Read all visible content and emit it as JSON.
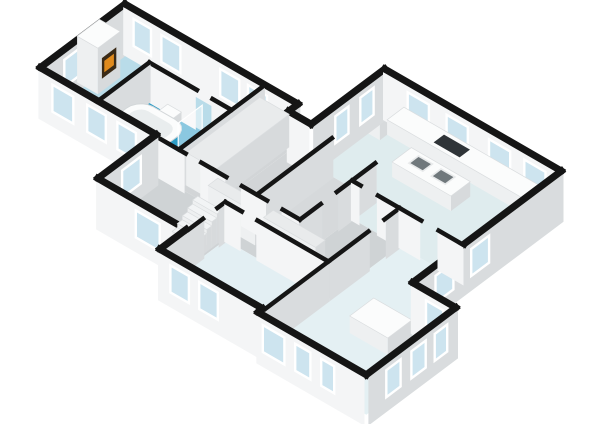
{
  "title": "3d-floor-plan",
  "colors": {
    "background": "#ffffff",
    "wall_cap": "#151515",
    "wall_face_bright": "#f4f5f6",
    "wall_face_shaded": "#d9dcde",
    "plinth": "#eceeef",
    "glass": "#cde4ef",
    "window_frame": "#ffffff",
    "floor_living": "#b9dce9",
    "floor_bathroom": "#2d9cc6",
    "floor_shower": "#1f87b6",
    "floor_hall": "#cfd3d5",
    "floor_storage": "#d2d5d7",
    "floor_kitchen": "#dfecee",
    "floor_bedroom": "#e3eff3",
    "fixture_white": "#f7f8f9",
    "fixture_top": "#fbfcfc",
    "fire_glow": "#e08a1c",
    "fire_dark": "#3a2a16",
    "sink_metal": "#70787c",
    "cooktop": "#2f3438"
  },
  "scene": {
    "origin": [
      125,
      44
    ],
    "u": [
      0.866,
      0.5
    ],
    "w": [
      -0.8,
      0.6
    ],
    "wall_height_ext": 40,
    "wall_height_int": 38,
    "plinth_extra": 8,
    "floors": [
      {
        "name": "living-room-floor",
        "color": "#b9dce9",
        "pts": [
          [
            0,
            0
          ],
          [
            160,
            0
          ],
          [
            160,
            40
          ],
          [
            65,
            40
          ],
          [
            65,
            106
          ],
          [
            0,
            106
          ]
        ]
      },
      {
        "name": "bathroom-floor",
        "color": "#2d9cc6",
        "pts": [
          [
            65,
            40
          ],
          [
            160,
            40
          ],
          [
            160,
            106
          ],
          [
            65,
            106
          ]
        ]
      },
      {
        "name": "wing-closet-zone-floor",
        "color": "#d2d5d7",
        "pts": [
          [
            160,
            0
          ],
          [
            200,
            0
          ],
          [
            200,
            106
          ],
          [
            160,
            106
          ]
        ]
      },
      {
        "name": "hallway-floor",
        "color": "#cfd3d5",
        "pts": [
          [
            134,
            106
          ],
          [
            300,
            106
          ],
          [
            300,
            41
          ],
          [
            355,
            41
          ],
          [
            355,
            130
          ],
          [
            236,
            130
          ],
          [
            236,
            179
          ],
          [
            134,
            179
          ]
        ]
      },
      {
        "name": "storage-room-1-floor",
        "color": "#d2d5d7",
        "pts": [
          [
            200,
            12
          ],
          [
            250,
            12
          ],
          [
            250,
            106
          ],
          [
            200,
            106
          ]
        ]
      },
      {
        "name": "storage-room-2-floor",
        "color": "#d6d9db",
        "pts": [
          [
            250,
            12
          ],
          [
            300,
            12
          ],
          [
            300,
            106
          ],
          [
            250,
            106
          ]
        ]
      },
      {
        "name": "kitchen-floor",
        "color": "#dfecee",
        "pts": [
          [
            226,
            -80
          ],
          [
            430,
            -80
          ],
          [
            430,
            41
          ],
          [
            300,
            41
          ],
          [
            300,
            12
          ],
          [
            226,
            12
          ]
        ]
      },
      {
        "name": "bedroom-1-floor",
        "color": "#e3eff3",
        "pts": [
          [
            236,
            130
          ],
          [
            355,
            130
          ],
          [
            355,
            212
          ],
          [
            236,
            212
          ]
        ]
      },
      {
        "name": "bedroom-2-floor",
        "color": "#e4f0f3",
        "pts": [
          [
            355,
            41
          ],
          [
            430,
            41
          ],
          [
            430,
            106
          ],
          [
            480,
            106
          ],
          [
            480,
            218
          ],
          [
            355,
            218
          ]
        ]
      }
    ],
    "walls": [
      {
        "name": "wing-north-wall",
        "p": [
          0,
          0,
          200,
          0
        ],
        "ext": true,
        "win": [
          [
            0.06,
            0.16
          ],
          [
            0.22,
            0.33
          ],
          [
            0.56,
            0.67
          ],
          [
            0.72,
            0.83
          ]
        ]
      },
      {
        "name": "wing-west-wall",
        "p": [
          0,
          0,
          0,
          106
        ],
        "ext": true,
        "win": [
          [
            0.5,
            0.74
          ]
        ]
      },
      {
        "name": "wing-south-wall",
        "p": [
          0,
          106,
          134,
          106
        ],
        "ext": true,
        "win": [
          [
            0.12,
            0.3
          ],
          [
            0.42,
            0.58
          ],
          [
            0.68,
            0.84
          ]
        ]
      },
      {
        "name": "hall-west-wall",
        "p": [
          134,
          106,
          134,
          179
        ],
        "ext": true,
        "win": [
          [
            0.3,
            0.62
          ]
        ]
      },
      {
        "name": "hall-south-wall",
        "p": [
          134,
          179,
          236,
          179
        ],
        "ext": true,
        "win": [
          [
            0.45,
            0.72
          ]
        ]
      },
      {
        "name": "bedroom-1-west-ext-wall",
        "p": [
          236,
          179,
          236,
          212
        ],
        "ext": true,
        "win": []
      },
      {
        "name": "bedroom-1-south-wall",
        "p": [
          236,
          212,
          355,
          212
        ],
        "ext": true,
        "win": [
          [
            0.12,
            0.3
          ],
          [
            0.4,
            0.58
          ]
        ]
      },
      {
        "name": "south-step-wall",
        "p": [
          355,
          212,
          355,
          218
        ],
        "ext": true,
        "win": []
      },
      {
        "name": "bedroom-2-south-wall",
        "p": [
          355,
          218,
          480,
          218
        ],
        "ext": true,
        "win": [
          [
            0.06,
            0.26
          ],
          [
            0.36,
            0.5
          ],
          [
            0.6,
            0.72
          ]
        ]
      },
      {
        "name": "bedroom-2-east-wall",
        "p": [
          480,
          218,
          480,
          106
        ],
        "ext": true,
        "win": [
          [
            0.2,
            0.36
          ],
          [
            0.48,
            0.64
          ],
          [
            0.74,
            0.88
          ]
        ]
      },
      {
        "name": "bedroom-2-north-ext-wall",
        "p": [
          480,
          106,
          430,
          106
        ],
        "ext": true,
        "win": [
          [
            0.25,
            0.65
          ]
        ]
      },
      {
        "name": "kitchen-east-wall",
        "p": [
          430,
          106,
          430,
          -80
        ],
        "ext": true,
        "win": [
          [
            0.14,
            0.26
          ],
          [
            0.38,
            0.5
          ]
        ]
      },
      {
        "name": "kitchen-north-wall",
        "p": [
          430,
          -80,
          226,
          -80
        ],
        "ext": true,
        "win": [
          [
            0.08,
            0.2
          ],
          [
            0.28,
            0.4
          ],
          [
            0.52,
            0.64
          ],
          [
            0.74,
            0.86
          ]
        ]
      },
      {
        "name": "kitchen-west-wall",
        "p": [
          226,
          -80,
          226,
          12
        ],
        "ext": true,
        "win": [
          [
            0.18,
            0.36
          ],
          [
            0.52,
            0.7
          ]
        ]
      },
      {
        "name": "storage-north-wall",
        "p": [
          226,
          12,
          200,
          12
        ],
        "ext": true,
        "win": []
      },
      {
        "name": "wing-east-jog-wall",
        "p": [
          200,
          12,
          200,
          0
        ],
        "ext": true,
        "win": []
      },
      {
        "name": "wing-south-int-a",
        "p": [
          134,
          106,
          168,
          106
        ],
        "ext": false,
        "win": []
      },
      {
        "name": "wing-south-int-b",
        "p": [
          186,
          106,
          200,
          106
        ],
        "ext": false,
        "win": []
      },
      {
        "name": "wing-divider-wall",
        "p": [
          160,
          0,
          160,
          106
        ],
        "ext": false,
        "win": []
      },
      {
        "name": "bathroom-west-wall",
        "p": [
          65,
          40,
          65,
          106
        ],
        "ext": false,
        "win": []
      },
      {
        "name": "bathroom-north-wall-a",
        "p": [
          65,
          40,
          120,
          40
        ],
        "ext": false,
        "win": []
      },
      {
        "name": "bathroom-north-wall-b",
        "p": [
          138,
          40,
          160,
          40
        ],
        "ext": false,
        "win": []
      },
      {
        "name": "storage-south-wall-a",
        "p": [
          200,
          106,
          215,
          106
        ],
        "ext": false,
        "win": []
      },
      {
        "name": "storage-south-wall-b",
        "p": [
          233,
          106,
          262,
          106
        ],
        "ext": false,
        "win": []
      },
      {
        "name": "storage-south-wall-c",
        "p": [
          280,
          106,
          300,
          106
        ],
        "ext": false,
        "win": []
      },
      {
        "name": "storage-divider-wall",
        "p": [
          250,
          12,
          250,
          106
        ],
        "ext": false,
        "win": []
      },
      {
        "name": "storage-east-wall-a",
        "p": [
          300,
          12,
          300,
          60
        ],
        "ext": false,
        "win": []
      },
      {
        "name": "storage-east-wall-b",
        "p": [
          300,
          80,
          300,
          106
        ],
        "ext": false,
        "win": []
      },
      {
        "name": "bedroom-1-north-wall-a",
        "p": [
          236,
          130,
          255,
          130
        ],
        "ext": false,
        "win": []
      },
      {
        "name": "bedroom-1-north-wall-b",
        "p": [
          273,
          130,
          355,
          130
        ],
        "ext": false,
        "win": []
      },
      {
        "name": "bedroom-1-west-wall-a",
        "p": [
          236,
          130,
          236,
          140
        ],
        "ext": false,
        "win": []
      },
      {
        "name": "bedroom-1-west-wall-b",
        "p": [
          236,
          158,
          236,
          179
        ],
        "ext": false,
        "win": []
      },
      {
        "name": "bedroom-2-west-wall-a",
        "p": [
          355,
          41,
          355,
          60
        ],
        "ext": false,
        "win": []
      },
      {
        "name": "bedroom-2-west-wall-b",
        "p": [
          355,
          80,
          355,
          130
        ],
        "ext": false,
        "win": []
      },
      {
        "name": "bedroom-divider-wall",
        "p": [
          355,
          130,
          355,
          212
        ],
        "ext": false,
        "win": []
      },
      {
        "name": "kitchen-hall-wall-a",
        "p": [
          300,
          41,
          310,
          41
        ],
        "ext": false,
        "win": []
      },
      {
        "name": "kitchen-hall-wall-b",
        "p": [
          330,
          41,
          355,
          41
        ],
        "ext": false,
        "win": []
      },
      {
        "name": "kitchen-bedroom2-wall-a",
        "p": [
          355,
          41,
          380,
          41
        ],
        "ext": false,
        "win": []
      },
      {
        "name": "kitchen-bedroom2-wall-b",
        "p": [
          400,
          41,
          430,
          41
        ],
        "ext": false,
        "win": []
      }
    ],
    "fixtures": [
      {
        "type": "box",
        "name": "living-room-fireplace",
        "r": [
          2,
          34,
          26,
          62
        ],
        "zh": 46,
        "fire": "e"
      },
      {
        "type": "tub",
        "name": "bathtub",
        "r": [
          68,
          56,
          126,
          94
        ],
        "zh": 13,
        "radius": 16
      },
      {
        "type": "shower",
        "name": "shower-tray",
        "r": [
          128,
          42,
          158,
          72
        ],
        "color": "#1f87b6"
      },
      {
        "type": "box",
        "name": "toilet",
        "r": [
          88,
          42,
          104,
          54
        ],
        "zh": 9
      },
      {
        "type": "box",
        "name": "wing-wardrobe",
        "r": [
          163,
          8,
          197,
          100
        ],
        "zh": 33,
        "top": "#e9ebec"
      },
      {
        "type": "box",
        "name": "hall-wardrobe-1",
        "r": [
          206,
          107,
          260,
          119
        ],
        "zh": 33,
        "top": "#e9ebec"
      },
      {
        "type": "box",
        "name": "hall-wardrobe-2",
        "r": [
          270,
          107,
          330,
          119
        ],
        "zh": 33,
        "top": "#e9ebec"
      },
      {
        "type": "steps",
        "name": "staircase",
        "a1": 206,
        "a2": 234,
        "b0": 132,
        "n": 7,
        "depth": 6.4,
        "h0": 30,
        "dh": 4
      },
      {
        "type": "box",
        "name": "kitchen-fridge",
        "r": [
          228,
          -78,
          250,
          -48
        ],
        "zh": 22
      },
      {
        "type": "box",
        "name": "kitchen-counter",
        "r": [
          250,
          -78,
          426,
          -57
        ],
        "zh": 15,
        "cooktop": [
          300,
          -74,
          330,
          -61
        ]
      },
      {
        "type": "box",
        "name": "kitchen-island",
        "r": [
          290,
          -44,
          358,
          -20
        ],
        "zh": 15,
        "sinks": [
          [
            302,
            -40,
            318,
            -28
          ],
          [
            328,
            -40,
            344,
            -28
          ]
        ]
      },
      {
        "type": "box",
        "name": "kitchen-fireplace",
        "r": [
          416,
          -48,
          430,
          -26
        ],
        "zh": 24,
        "fire": "w"
      },
      {
        "type": "box",
        "name": "bedroom-2-cabinet",
        "r": [
          398,
          120,
          442,
          150
        ],
        "zh": 17
      }
    ]
  }
}
